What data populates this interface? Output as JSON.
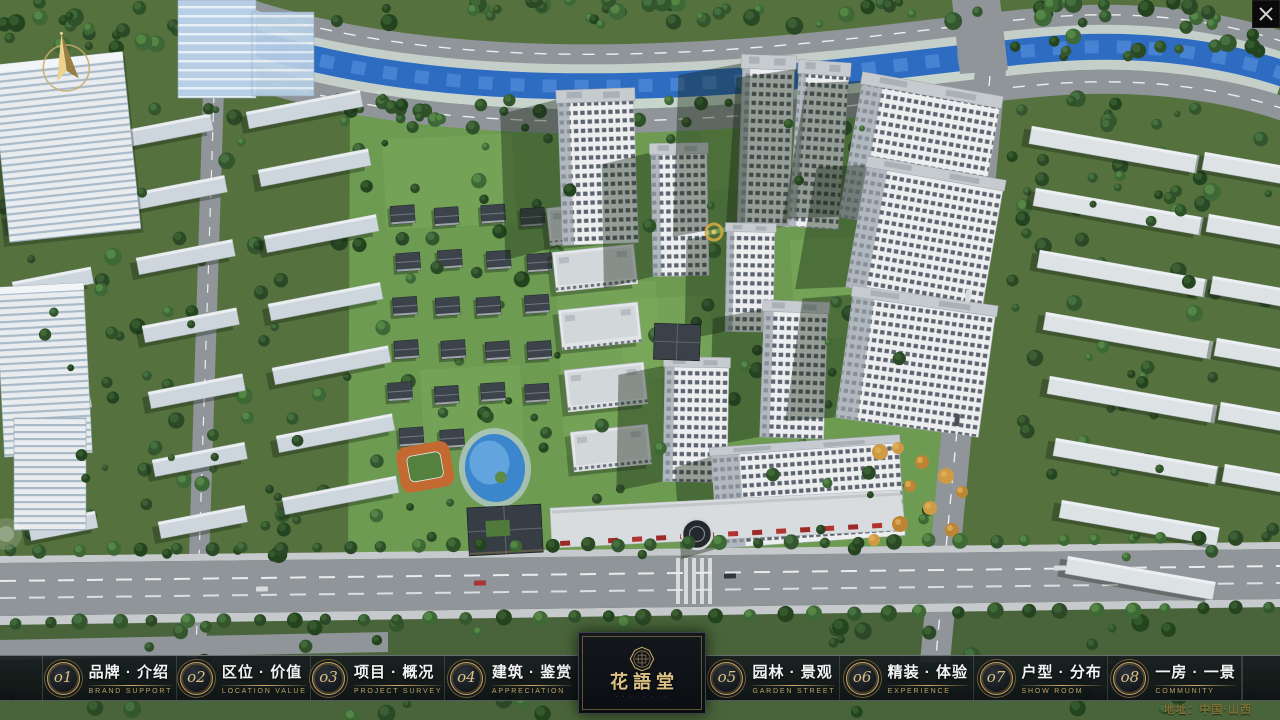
{
  "nav": {
    "items": [
      {
        "num": "o1",
        "label": "品牌 · 介绍",
        "sub": "BRAND SUPPORT"
      },
      {
        "num": "o2",
        "label": "区位 · 价值",
        "sub": "LOCATION VALUE"
      },
      {
        "num": "o3",
        "label": "项目 · 概况",
        "sub": "PROJECT SURVEY"
      },
      {
        "num": "o4",
        "label": "建筑 · 鉴赏",
        "sub": "APPRECIATION"
      },
      {
        "num": "o5",
        "label": "园林 · 景观",
        "sub": "GARDEN STREET"
      },
      {
        "num": "o6",
        "label": "精装 · 体验",
        "sub": "EXPERIENCE"
      },
      {
        "num": "o7",
        "label": "户型 · 分布",
        "sub": "SHOW ROOM"
      },
      {
        "num": "o8",
        "label": "一房 · 一景",
        "sub": "COMMUNITY"
      }
    ]
  },
  "logo": {
    "title": "花語堂",
    "subtext": "· · · · · · · ·"
  },
  "footer": {
    "address": "地址：中国·山西"
  },
  "colors": {
    "gold": "#c9ab6d",
    "bar_bg": "#0d1116",
    "river_blue": "#2d6cc0",
    "grass_green": "#6d9b52",
    "road_grey": "#8f9598"
  }
}
